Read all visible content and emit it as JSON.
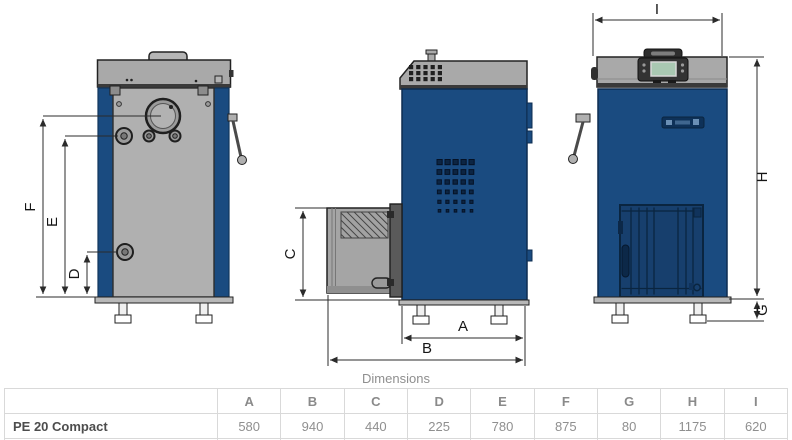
{
  "figure": {
    "description": "Three-view technical dimension drawing of PE 20 Compact boiler",
    "views": [
      {
        "name": "back-view"
      },
      {
        "name": "side-view"
      },
      {
        "name": "front-view"
      }
    ],
    "dimension_labels": {
      "A": "A",
      "B": "B",
      "C": "C",
      "D": "D",
      "E": "E",
      "F": "F",
      "G": "G",
      "H": "H",
      "I": "I"
    }
  },
  "table": {
    "title": "Dimensions",
    "columns": [
      "A",
      "B",
      "C",
      "D",
      "E",
      "F",
      "G",
      "H",
      "I"
    ],
    "rows": [
      {
        "label": "PE 20 Compact",
        "values": [
          "580",
          "940",
          "440",
          "225",
          "780",
          "875",
          "80",
          "1175",
          "620"
        ]
      }
    ]
  },
  "colors": {
    "boiler_blue": "#1a4b80",
    "door_blue": "#173f6d",
    "panel_gray": "#a9a9a9",
    "back_panel_gray": "#b0b0b0",
    "screen_green": "#a9c8b2",
    "dimension_line": "#2b2b2b",
    "table_border": "#d9d9d9",
    "table_text": "#8f8f8f",
    "row_label_text": "#4d4d4d"
  }
}
